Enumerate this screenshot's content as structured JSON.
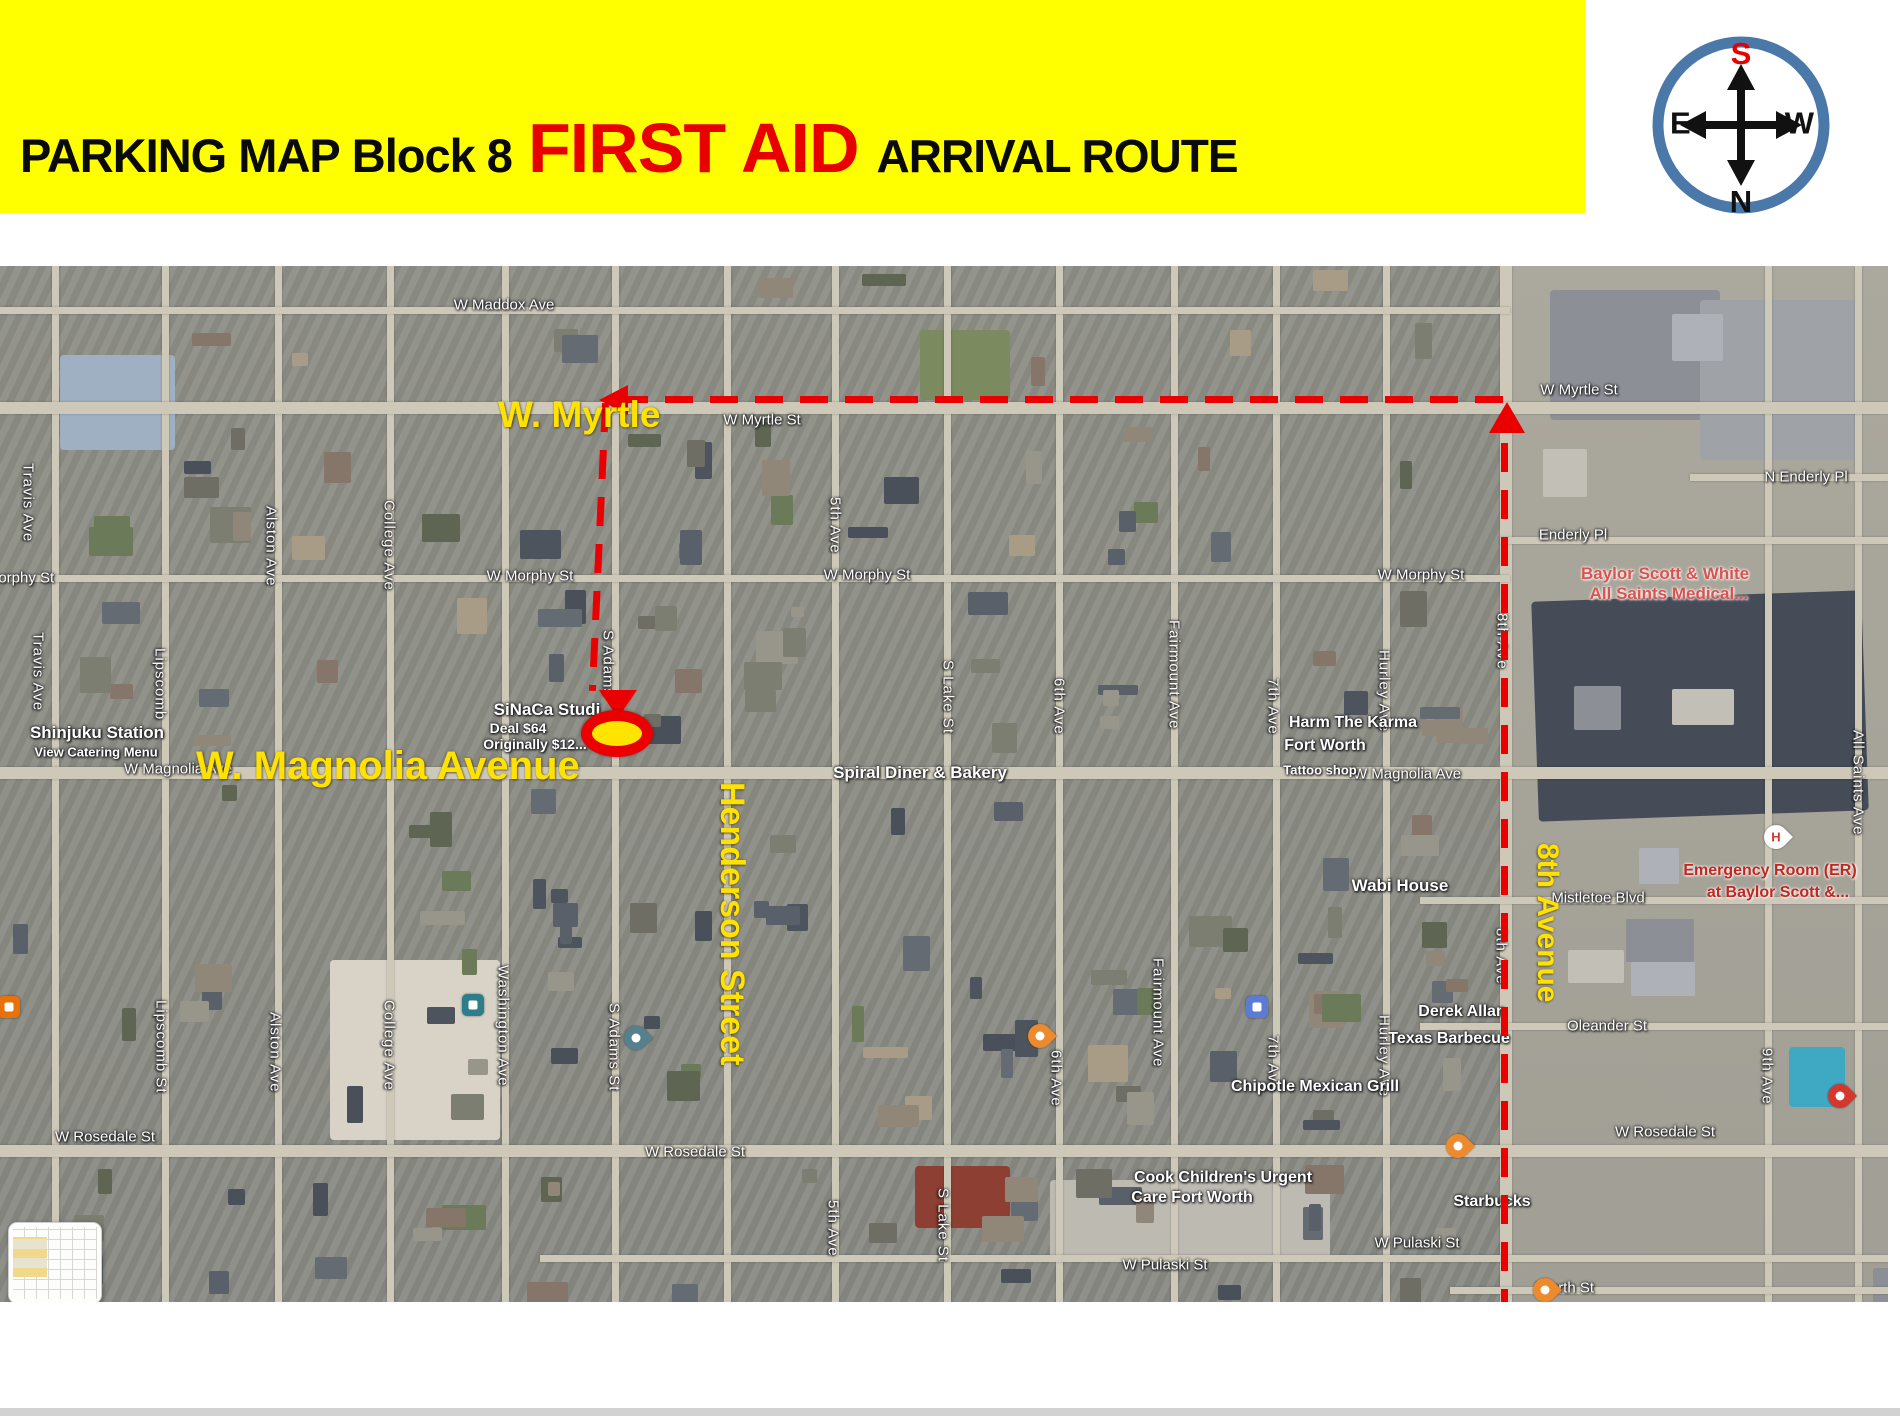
{
  "header": {
    "title_prefix": "PARKING MAP",
    "title_block": "Block 8",
    "title_highlight": "FIRST AID",
    "title_suffix": "ARRIVAL ROUTE",
    "banner_color": "#ffff00",
    "highlight_color": "#e80000"
  },
  "compass": {
    "top": "S",
    "bottom": "N",
    "left": "E",
    "right": "W",
    "top_color": "#e80000",
    "ring_color": "#4a78a8"
  },
  "map": {
    "route_color": "#ea0000",
    "destination_fill": "#ffe400",
    "route_labels": [
      {
        "text": "W. Myrtle",
        "x": 498,
        "y": 394,
        "size": 37,
        "vertical": false
      },
      {
        "text": "W. Magnolia Avenue",
        "x": 196,
        "y": 744,
        "size": 40,
        "vertical": false
      },
      {
        "text": "Henderson Street",
        "x": 712,
        "y": 782,
        "size": 34,
        "vertical": true
      },
      {
        "text": "8th Avenue",
        "x": 1530,
        "y": 843,
        "size": 30,
        "vertical": true
      }
    ],
    "street_labels_h": [
      {
        "text": "W Maddox Ave",
        "x": 504,
        "y": 305
      },
      {
        "text": "W Myrtle St",
        "x": 762,
        "y": 420
      },
      {
        "text": "W Myrtle St",
        "x": 1579,
        "y": 390
      },
      {
        "text": "Morphy St",
        "x": 20,
        "y": 578
      },
      {
        "text": "W Morphy St",
        "x": 530,
        "y": 576
      },
      {
        "text": "W Morphy St",
        "x": 867,
        "y": 575
      },
      {
        "text": "W Morphy St",
        "x": 1421,
        "y": 575
      },
      {
        "text": "W Magnolia Ave",
        "x": 178,
        "y": 769
      },
      {
        "text": "W Magnolia Ave",
        "x": 1407,
        "y": 774
      },
      {
        "text": "Enderly Pl",
        "x": 1573,
        "y": 535
      },
      {
        "text": "N Enderly Pl",
        "x": 1806,
        "y": 477
      },
      {
        "text": "Mistletoe Blvd",
        "x": 1598,
        "y": 898
      },
      {
        "text": "Oleander St",
        "x": 1607,
        "y": 1026
      },
      {
        "text": "W Rosedale St",
        "x": 105,
        "y": 1137
      },
      {
        "text": "W Rosedale St",
        "x": 695,
        "y": 1152
      },
      {
        "text": "W Rosedale St",
        "x": 1665,
        "y": 1132
      },
      {
        "text": "W Pulaski St",
        "x": 1165,
        "y": 1265
      },
      {
        "text": "W Pulaski St",
        "x": 1417,
        "y": 1243
      },
      {
        "text": "Worth St",
        "x": 1565,
        "y": 1288
      }
    ],
    "street_labels_v": [
      {
        "text": "Travis Ave",
        "x": 28,
        "y": 463
      },
      {
        "text": "Travis Ave",
        "x": 38,
        "y": 632
      },
      {
        "text": "Travis Ave",
        "x": 50,
        "y": 1262
      },
      {
        "text": "Lipscomb",
        "x": 160,
        "y": 648
      },
      {
        "text": "Lipscomb St",
        "x": 161,
        "y": 1000
      },
      {
        "text": "Alston Ave",
        "x": 271,
        "y": 506
      },
      {
        "text": "Alston Ave",
        "x": 275,
        "y": 1012
      },
      {
        "text": "College Ave",
        "x": 389,
        "y": 500
      },
      {
        "text": "College Ave",
        "x": 389,
        "y": 1000
      },
      {
        "text": "Washington Ave",
        "x": 503,
        "y": 965
      },
      {
        "text": "S Adams",
        "x": 608,
        "y": 630
      },
      {
        "text": "S Adams St",
        "x": 614,
        "y": 1003
      },
      {
        "text": "5th Ave",
        "x": 835,
        "y": 497
      },
      {
        "text": "5th Ave",
        "x": 833,
        "y": 1200
      },
      {
        "text": "S Lake St",
        "x": 948,
        "y": 660
      },
      {
        "text": "S Lake St",
        "x": 943,
        "y": 1188
      },
      {
        "text": "6th Ave",
        "x": 1059,
        "y": 678
      },
      {
        "text": "6th Ave",
        "x": 1056,
        "y": 1050
      },
      {
        "text": "Fairmount Ave",
        "x": 1174,
        "y": 620
      },
      {
        "text": "Fairmount Ave",
        "x": 1158,
        "y": 958
      },
      {
        "text": "7th Ave",
        "x": 1273,
        "y": 678
      },
      {
        "text": "7th Ave",
        "x": 1273,
        "y": 1035
      },
      {
        "text": "Hurley Ave",
        "x": 1384,
        "y": 650
      },
      {
        "text": "Hurley Ave",
        "x": 1384,
        "y": 1015
      },
      {
        "text": "8th Ave",
        "x": 1502,
        "y": 613
      },
      {
        "text": "8th Ave",
        "x": 1501,
        "y": 928
      },
      {
        "text": "9th Ave",
        "x": 1767,
        "y": 1048
      },
      {
        "text": "All Saints Ave",
        "x": 1858,
        "y": 730
      }
    ],
    "poi_labels": [
      {
        "text": "Shinjuku Station",
        "x": 97,
        "y": 733,
        "size": 17,
        "color": "white"
      },
      {
        "text": "View Catering Menu",
        "x": 96,
        "y": 752,
        "size": 13,
        "color": "white"
      },
      {
        "text": "SiNaCa Studi",
        "x": 547,
        "y": 710,
        "size": 17,
        "color": "white"
      },
      {
        "text": "Deal $64",
        "x": 518,
        "y": 728,
        "size": 14,
        "color": "white"
      },
      {
        "text": "Originally $12...",
        "x": 535,
        "y": 744,
        "size": 14,
        "color": "white"
      },
      {
        "text": "Spiral Diner & Bakery",
        "x": 920,
        "y": 773,
        "size": 17,
        "color": "white"
      },
      {
        "text": "Harm The Karma",
        "x": 1353,
        "y": 723,
        "size": 16,
        "color": "white"
      },
      {
        "text": "Fort Worth",
        "x": 1325,
        "y": 746,
        "size": 16,
        "color": "white"
      },
      {
        "text": "Tattoo shop",
        "x": 1320,
        "y": 770,
        "size": 13,
        "color": "white"
      },
      {
        "text": "Baylor Scott & White",
        "x": 1665,
        "y": 574,
        "size": 17,
        "color": "pink"
      },
      {
        "text": "All Saints Medical...",
        "x": 1669,
        "y": 594,
        "size": 17,
        "color": "pink"
      },
      {
        "text": "Emergency Room (ER)",
        "x": 1770,
        "y": 871,
        "size": 16,
        "color": "red"
      },
      {
        "text": "at Baylor Scott &...",
        "x": 1778,
        "y": 893,
        "size": 16,
        "color": "red"
      },
      {
        "text": "Wabi House",
        "x": 1400,
        "y": 886,
        "size": 17,
        "color": "white"
      },
      {
        "text": "Derek Allan",
        "x": 1462,
        "y": 1012,
        "size": 16,
        "color": "white"
      },
      {
        "text": "Texas Barbecue",
        "x": 1449,
        "y": 1039,
        "size": 16,
        "color": "white"
      },
      {
        "text": "Chipotle Mexican Grill",
        "x": 1315,
        "y": 1087,
        "size": 16,
        "color": "white"
      },
      {
        "text": "Cook Children's Urgent",
        "x": 1223,
        "y": 1178,
        "size": 16,
        "color": "white"
      },
      {
        "text": "Care Fort Worth",
        "x": 1192,
        "y": 1198,
        "size": 16,
        "color": "white"
      },
      {
        "text": "Starbucks",
        "x": 1492,
        "y": 1202,
        "size": 16,
        "color": "white"
      }
    ],
    "pins": [
      {
        "kind": "drop",
        "name": "spiral-diner-pin",
        "x": 1040,
        "y": 770,
        "color": "#ed8a2e"
      },
      {
        "kind": "drop",
        "name": "wabi-house-pin",
        "x": 1458,
        "y": 880,
        "color": "#ed8a2e"
      },
      {
        "kind": "drop",
        "name": "derek-allan-pin",
        "x": 1545,
        "y": 1024,
        "color": "#ed8a2e"
      },
      {
        "kind": "drop",
        "name": "chipotle-pin",
        "x": 1422,
        "y": 1083,
        "color": "#ed8a2e"
      },
      {
        "kind": "drop",
        "name": "starbucks-coffee-pin",
        "x": 1554,
        "y": 1191,
        "color": "#ed8a2e"
      },
      {
        "kind": "drop",
        "name": "magnolia-map-pin",
        "x": 636,
        "y": 772,
        "color": "#55808c"
      },
      {
        "kind": "drop",
        "name": "cook-childrens-pin",
        "x": 1104,
        "y": 1180,
        "color": "#55808c"
      },
      {
        "kind": "drop",
        "name": "emergency-room-pin",
        "x": 1840,
        "y": 830,
        "color": "#d6372c"
      },
      {
        "kind": "drop-h",
        "name": "hospital-h-pin",
        "x": 1776,
        "y": 571,
        "color": "#d6372c",
        "glyph": "H"
      },
      {
        "kind": "square",
        "name": "tattoo-shop-icon",
        "x": 1258,
        "y": 742,
        "color": "#5b7bd5"
      },
      {
        "kind": "square",
        "name": "lodging-icon",
        "x": 176,
        "y": 1076,
        "color": "#5b7bd5"
      },
      {
        "kind": "square",
        "name": "sinaca-school-icon",
        "x": 474,
        "y": 740,
        "color": "#2d7d8a"
      },
      {
        "kind": "square",
        "name": "shinjuku-restaurant-icon",
        "x": 10,
        "y": 742,
        "color": "#e8710a"
      }
    ]
  }
}
